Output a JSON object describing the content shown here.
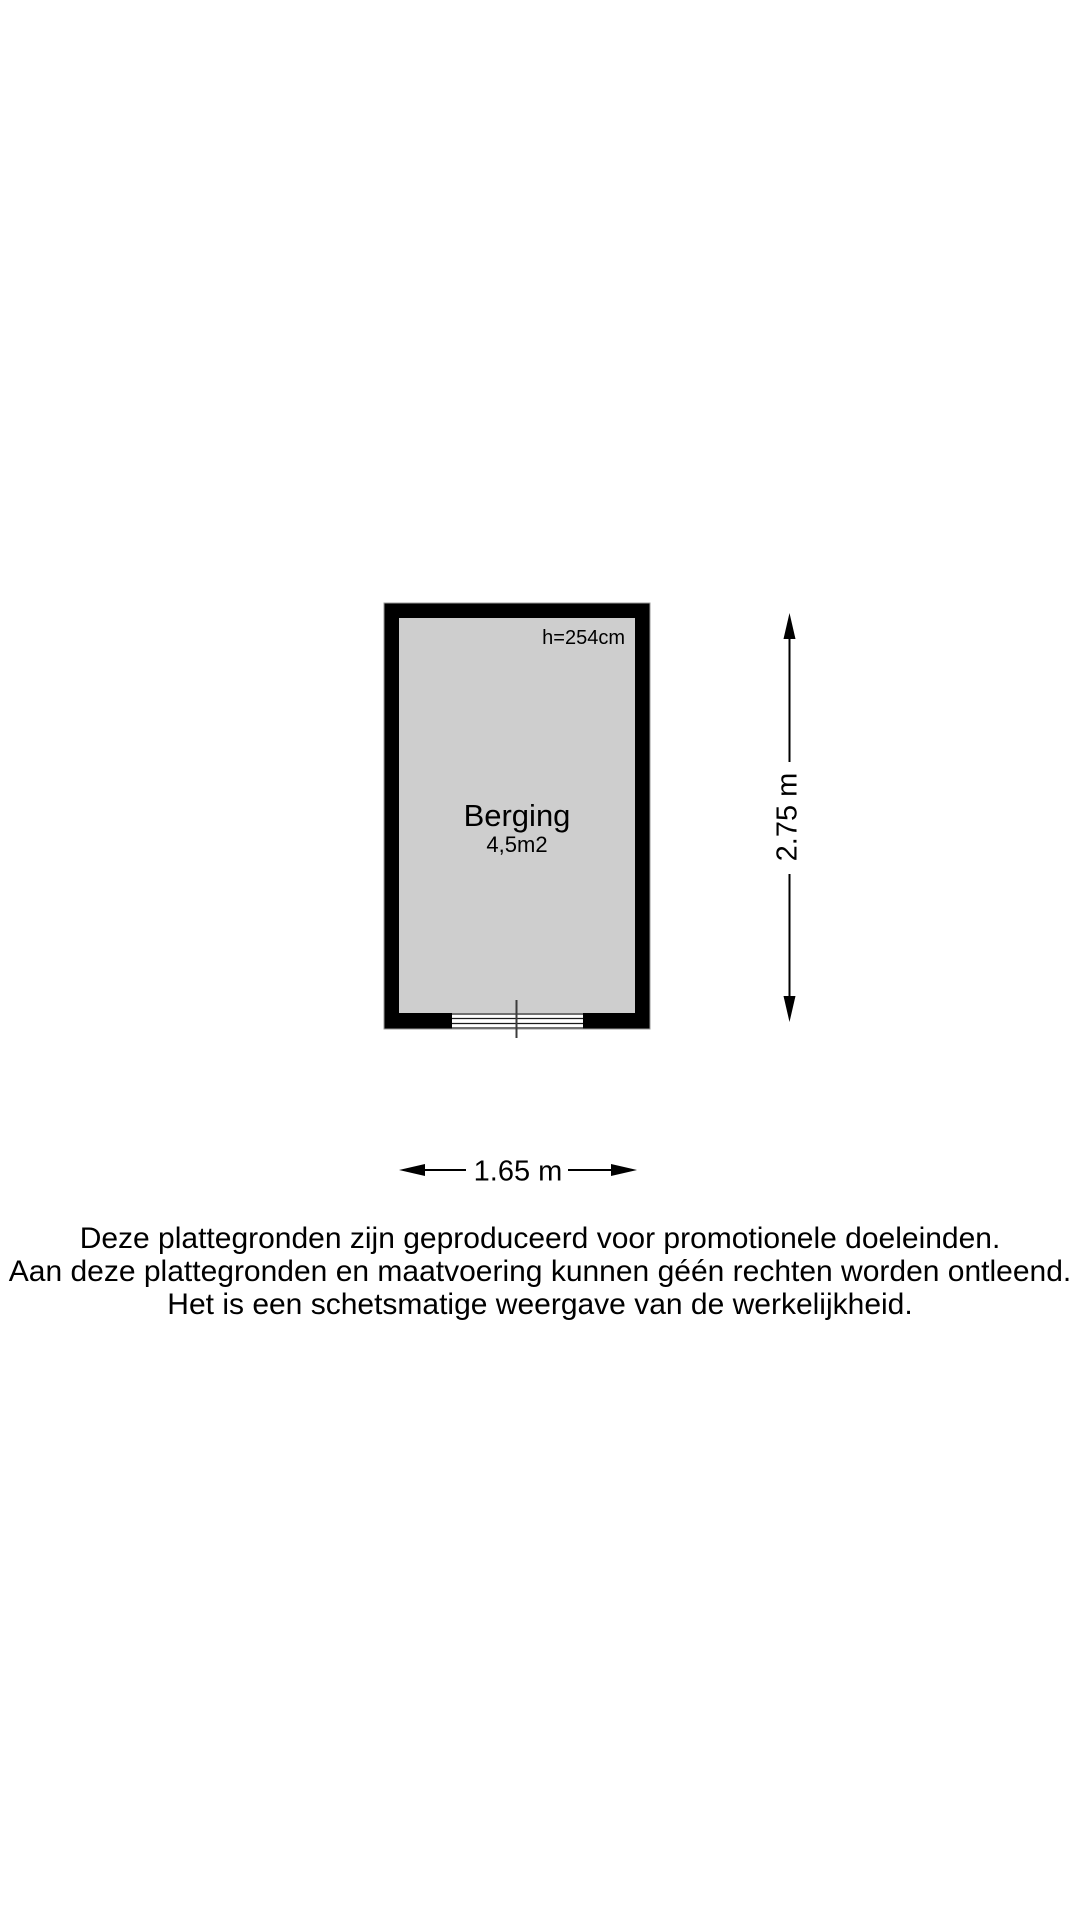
{
  "room": {
    "name": "Berging",
    "area": "4,5m2",
    "ceiling_height": "h=254cm"
  },
  "dimensions": {
    "height": "2.75 m",
    "width": "1.65 m"
  },
  "disclaimer": {
    "lines": [
      "Deze plattegronden zijn geproduceerd voor promotionele doeleinden.",
      "Aan deze plattegronden en maatvoering kunnen géén rechten worden ontleend.",
      "Het is een schetsmatige weergave van de werkelijkheid."
    ]
  },
  "colors": {
    "wall": "#000000",
    "floor": "#cecece",
    "background": "#ffffff",
    "text": "#000000"
  }
}
